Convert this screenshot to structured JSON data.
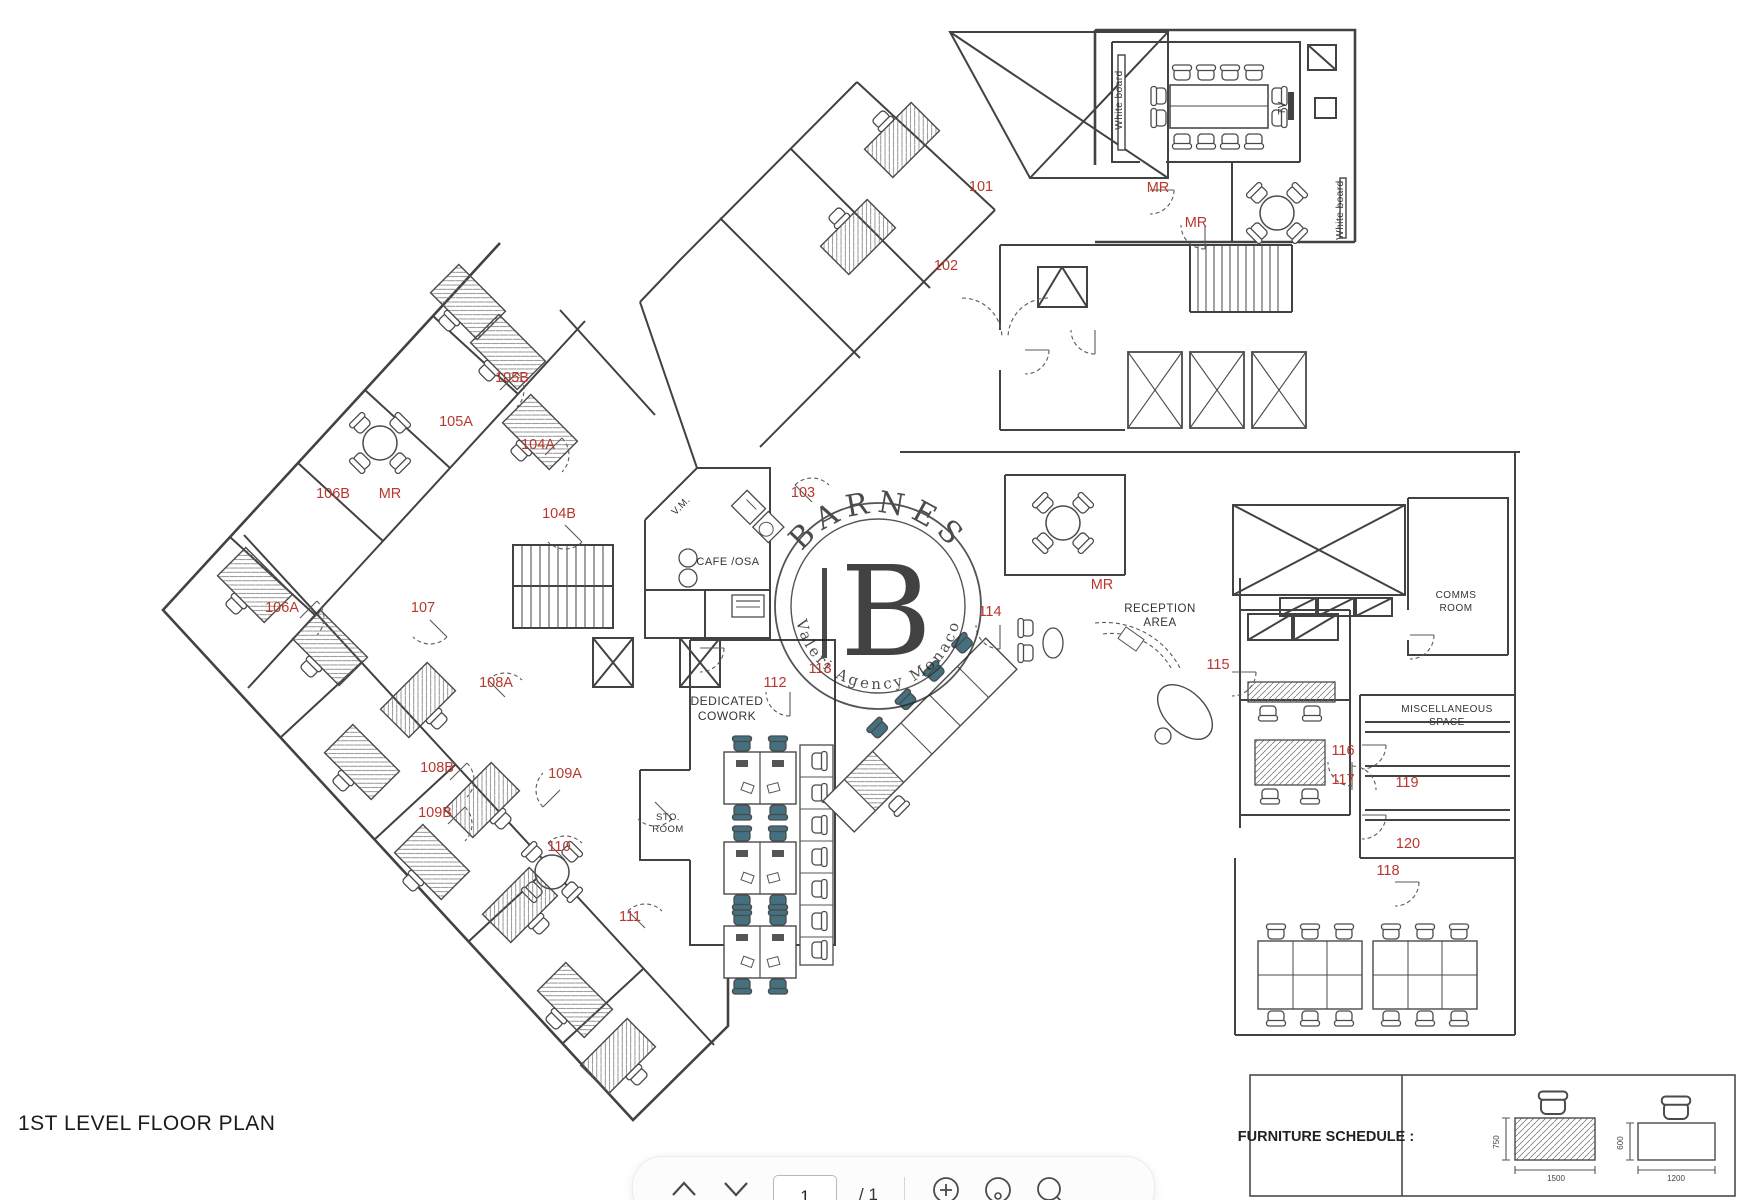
{
  "page": {
    "title": "1ST LEVEL FLOOR PLAN"
  },
  "watermark": {
    "brand": "BARNES",
    "monogram": "B",
    "tagline": "Valeri Agency Monaco"
  },
  "colors": {
    "label_red": "#b8372e",
    "wall": "#424242",
    "chair_teal": "#44707f"
  },
  "plan": {
    "room_labels": [
      {
        "t": "101",
        "x": 981,
        "y": 191
      },
      {
        "t": "102",
        "x": 946,
        "y": 270
      },
      {
        "t": "103",
        "x": 803,
        "y": 497
      },
      {
        "t": "104A",
        "x": 538,
        "y": 449
      },
      {
        "t": "104B",
        "x": 559,
        "y": 518
      },
      {
        "t": "105A",
        "x": 456,
        "y": 426
      },
      {
        "t": "105B",
        "x": 512,
        "y": 382
      },
      {
        "t": "106A",
        "x": 282,
        "y": 612
      },
      {
        "t": "106B",
        "x": 333,
        "y": 498
      },
      {
        "t": "107",
        "x": 423,
        "y": 612
      },
      {
        "t": "108A",
        "x": 496,
        "y": 687
      },
      {
        "t": "108B",
        "x": 437,
        "y": 772
      },
      {
        "t": "109A",
        "x": 565,
        "y": 778
      },
      {
        "t": "109B",
        "x": 435,
        "y": 817
      },
      {
        "t": "110",
        "x": 559,
        "y": 851
      },
      {
        "t": "111",
        "x": 630,
        "y": 921
      },
      {
        "t": "112",
        "x": 775,
        "y": 687
      },
      {
        "t": "113",
        "x": 820,
        "y": 673
      },
      {
        "t": "114",
        "x": 990,
        "y": 616
      },
      {
        "t": "115",
        "x": 1218,
        "y": 669
      },
      {
        "t": "116",
        "x": 1343,
        "y": 755
      },
      {
        "t": "117",
        "x": 1343,
        "y": 784
      },
      {
        "t": "118",
        "x": 1388,
        "y": 875
      },
      {
        "t": "119",
        "x": 1407,
        "y": 787
      },
      {
        "t": "120",
        "x": 1408,
        "y": 848
      },
      {
        "t": "MR",
        "x": 390,
        "y": 498
      },
      {
        "t": "MR",
        "x": 1158,
        "y": 192
      },
      {
        "t": "MR",
        "x": 1196,
        "y": 227
      },
      {
        "t": "MR",
        "x": 1102,
        "y": 589
      }
    ],
    "area_labels": [
      {
        "t": "RECEPTION",
        "x": 1160,
        "y": 612,
        "s": 11.5
      },
      {
        "t": "AREA",
        "x": 1160,
        "y": 626,
        "s": 11.5
      },
      {
        "t": "DEDICATED",
        "x": 727,
        "y": 705,
        "s": 12
      },
      {
        "t": "COWORK",
        "x": 727,
        "y": 720,
        "s": 12
      },
      {
        "t": "CAFE /OSA",
        "x": 728,
        "y": 565,
        "s": 11
      },
      {
        "t": "STO.",
        "x": 668,
        "y": 820,
        "s": 9.5
      },
      {
        "t": "ROOM",
        "x": 668,
        "y": 832,
        "s": 9.5
      },
      {
        "t": "COMMS",
        "x": 1456,
        "y": 598,
        "s": 10
      },
      {
        "t": "ROOM",
        "x": 1456,
        "y": 611,
        "s": 10
      },
      {
        "t": "MISCELLANEOUS",
        "x": 1447,
        "y": 712,
        "s": 10
      },
      {
        "t": "SPACE",
        "x": 1447,
        "y": 725,
        "s": 10
      },
      {
        "t": "V.M.",
        "x": 683,
        "y": 508,
        "s": 10,
        "r": -45
      },
      {
        "t": "White board",
        "x": 1122,
        "y": 100,
        "s": 10,
        "r": -90
      },
      {
        "t": "White board",
        "x": 1343,
        "y": 210,
        "s": 10,
        "r": -90
      },
      {
        "t": "TV",
        "x": 1285,
        "y": 108,
        "s": 10,
        "r": -90
      }
    ]
  },
  "furniture_schedule": {
    "title": "FURNITURE SCHEDULE :",
    "desk1": {
      "width": "1500",
      "depth": "750"
    },
    "desk2": {
      "width": "1200",
      "depth": "600"
    }
  },
  "toolbar": {
    "page": "1",
    "page_total": "/ 1",
    "icons": [
      "page-up",
      "page-down",
      "zoom-in",
      "zoom-out",
      "search"
    ]
  }
}
